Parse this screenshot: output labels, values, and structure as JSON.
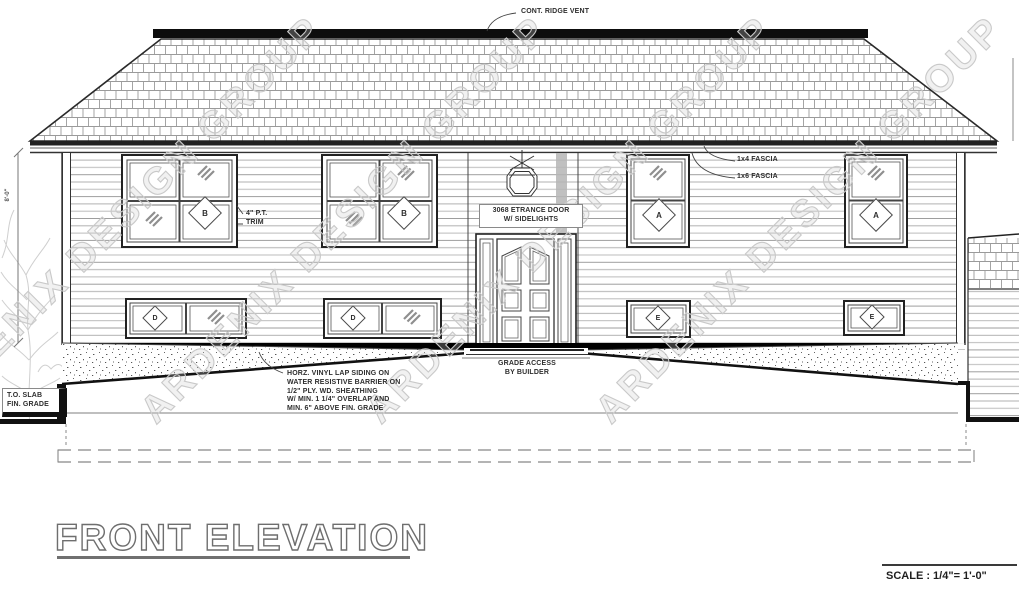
{
  "drawing": {
    "title": "FRONT ELEVATION",
    "scale_label": "SCALE : 1/4\"= 1'-0\"",
    "watermark": "ARDENIX DESIGN GROUP",
    "annotations": {
      "ridge_vent": "CONT. RIDGE VENT",
      "fascia_1x4": "1x4 FASCIA",
      "fascia_1x6": "1x6 FASCIA",
      "pt_trim": "4\" P.T.\nTRIM",
      "entrance_door": "3068 ETRANCE DOOR\nW/ SIDELIGHTS",
      "grade_access": "GRADE ACCESS\nBY BUILDER",
      "siding_note": "HORZ. VINYL LAP SIDING ON\nWATER RESISTIVE BARRIER ON\n1/2\" PLY. WD. SHEATHING\nW/ MIN. 1 1/4\" OVERLAP AND\nMIN. 6\" ABOVE FIN. GRADE",
      "slab_grade": "T.O. SLAB\nFIN. GRADE",
      "left_dimension": "8'-0\""
    },
    "window_tags": [
      {
        "label": "B"
      },
      {
        "label": "B"
      },
      {
        "label": "A"
      },
      {
        "label": "A"
      },
      {
        "label": "D"
      },
      {
        "label": "D"
      },
      {
        "label": "E"
      },
      {
        "label": "E"
      }
    ],
    "colors": {
      "line": "#2e2e2e",
      "light_line": "#b2b2b2",
      "watermark": "#c9c9c9",
      "shadow": "#b5b5b5",
      "black": "#111111"
    }
  }
}
